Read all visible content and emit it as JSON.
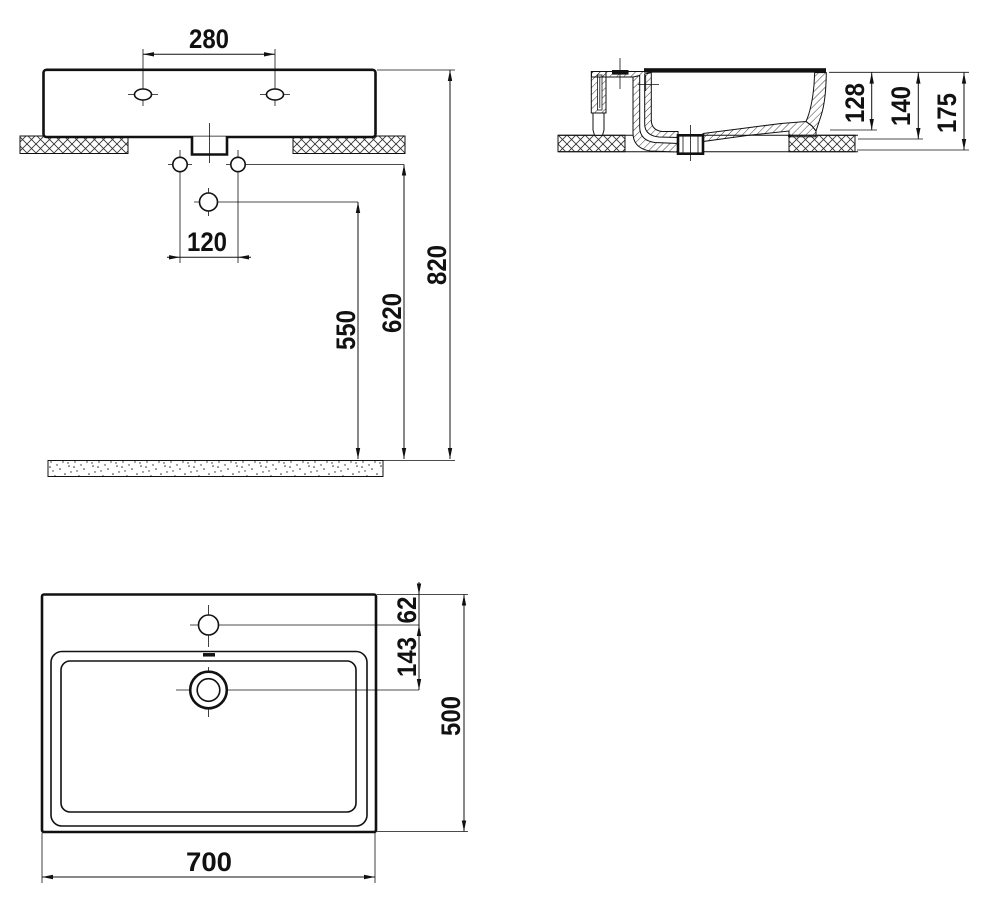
{
  "views": {
    "front": {
      "dims": {
        "tap_hole_spacing_mm": "280",
        "supply_hole_spacing_mm": "120",
        "drain_outlet_height_mm": "550",
        "supply_height_mm": "620",
        "rim_height_mm": "820"
      }
    },
    "side": {
      "dims": {
        "inner_depth_mm": "128",
        "bowl_depth_mm": "140",
        "overall_height_mm": "175"
      }
    },
    "plan": {
      "dims": {
        "tap_hole_offset_mm": "62",
        "drain_offset_mm": "143",
        "overall_depth_mm": "500",
        "overall_width_mm": "700"
      }
    }
  }
}
